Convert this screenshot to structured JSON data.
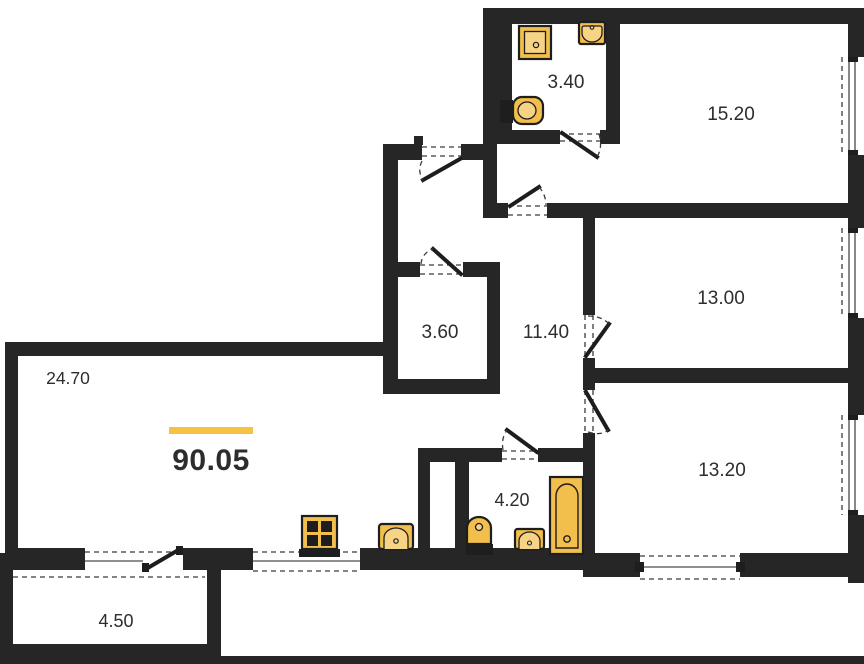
{
  "plan": {
    "title": "apartment-floor-plan",
    "total_area": "90.05",
    "rooms": {
      "bathroom_small": {
        "area": "3.40"
      },
      "bedroom_large": {
        "area": "15.20"
      },
      "bedroom_mid": {
        "area": "13.00"
      },
      "hallway": {
        "area": "11.40"
      },
      "storage": {
        "area": "3.60"
      },
      "living_kitchen": {
        "area": "24.70"
      },
      "bedroom_small": {
        "area": "13.20"
      },
      "bathroom_main": {
        "area": "4.20"
      },
      "balcony": {
        "area": "4.50"
      }
    },
    "fixtures": [
      "shower",
      "sink",
      "toilet",
      "stove",
      "bathtub"
    ],
    "colors": {
      "wall": "#262626",
      "fixture_fill": "#F2BE4C",
      "accent_line": "#F5C242",
      "text": "#2d2d2d"
    }
  }
}
